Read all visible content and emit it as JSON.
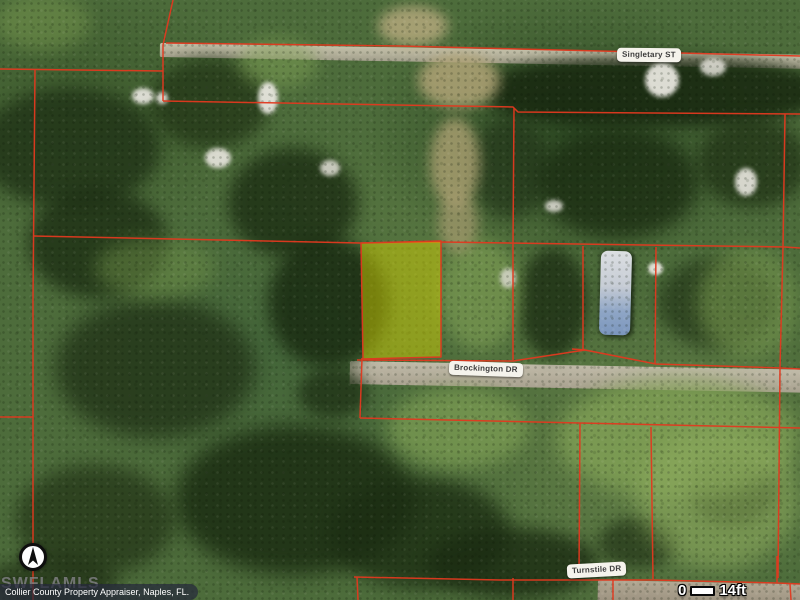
{
  "map_type": "aerial-parcel-map",
  "streets": {
    "singletary": "Singletary ST",
    "brockington": "Brockington DR",
    "turnstile": "Turnstile DR"
  },
  "scale_bar": {
    "start_label": "0",
    "end_label": "14ft"
  },
  "attribution": "Collier County Property Appraiser, Naples, FL.",
  "watermark": "SWFLAMLS",
  "colors": {
    "parcel_line": "#e2391f",
    "highlight_parcel_fill": "#d6d400",
    "label_background": "#f5f3ec",
    "label_text": "#3d3d3d"
  },
  "icons": {
    "north_arrow": "▲"
  }
}
